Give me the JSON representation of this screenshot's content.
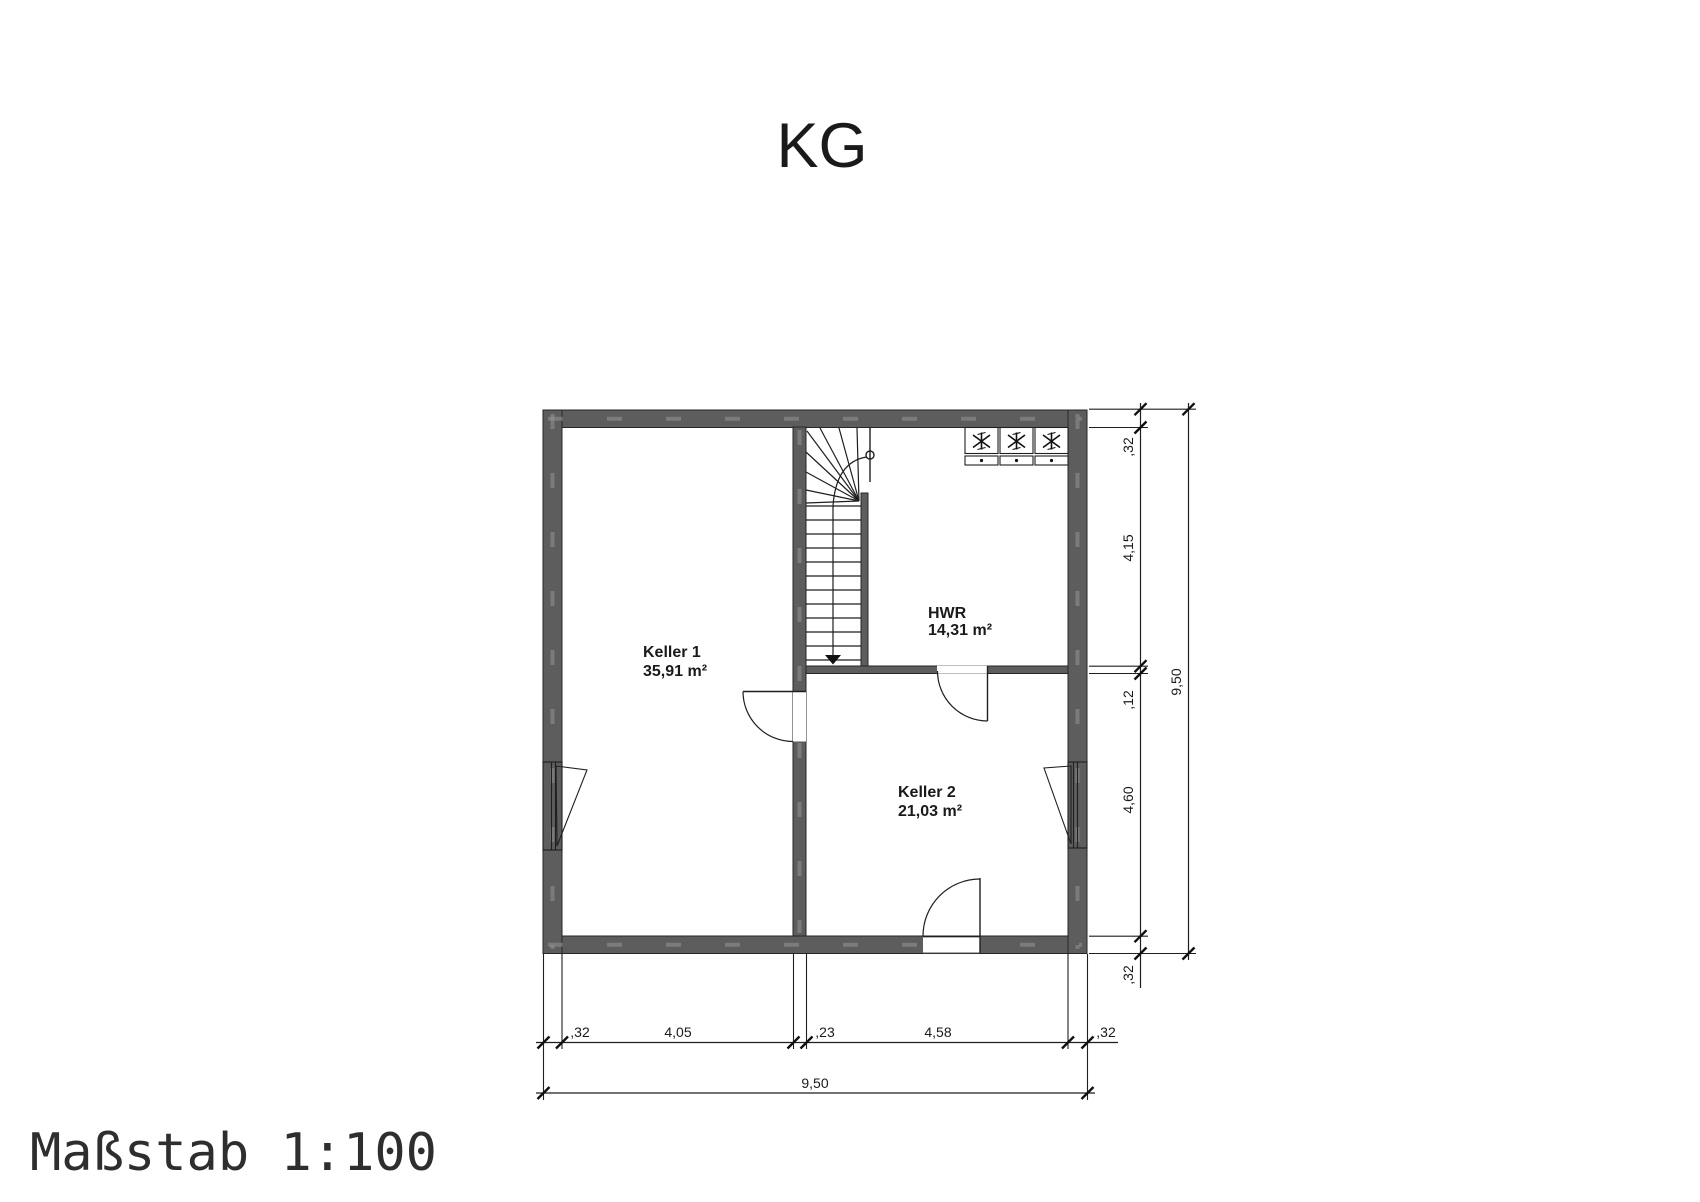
{
  "title": "KG",
  "scale_label": "Maßstab 1:100",
  "rooms": [
    {
      "name": "Keller 1",
      "area": "35,91 m²"
    },
    {
      "name": "Keller 2",
      "area": "21,03 m²"
    },
    {
      "name": "HWR",
      "area": "14,31 m²"
    }
  ],
  "dimensions": {
    "bottom_chain": [
      ",32",
      "4,05",
      ",23",
      "4,58",
      ",32"
    ],
    "bottom_total": "9,50",
    "right_chain": [
      ",32",
      "4,15",
      ",12",
      "4,60",
      ",32"
    ],
    "right_total": "9,50"
  },
  "colors": {
    "wall": "#5d5d5d",
    "line": "#1f1f1f",
    "background": "#ffffff"
  }
}
